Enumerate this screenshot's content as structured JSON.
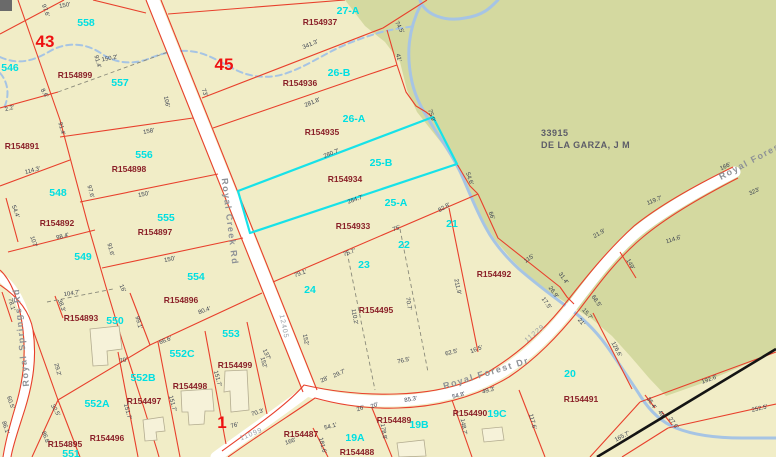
{
  "map": {
    "owner": {
      "line1": "33915",
      "line2": "DE LA GARZA, J M",
      "x": 541,
      "y": 133
    },
    "block_numbers": [
      {
        "t": "43",
        "x": 45,
        "y": 47
      },
      {
        "t": "45",
        "x": 224,
        "y": 70
      },
      {
        "t": "1",
        "x": 222,
        "y": 428
      }
    ],
    "lot_numbers": [
      {
        "t": "558",
        "x": 86,
        "y": 26
      },
      {
        "t": "546",
        "x": 10,
        "y": 71
      },
      {
        "t": "557",
        "x": 120,
        "y": 86
      },
      {
        "t": "27-A",
        "x": 348,
        "y": 14
      },
      {
        "t": "26-B",
        "x": 339,
        "y": 76
      },
      {
        "t": "26-A",
        "x": 354,
        "y": 122
      },
      {
        "t": "25-B",
        "x": 381,
        "y": 166
      },
      {
        "t": "25-A",
        "x": 396,
        "y": 206
      },
      {
        "t": "556",
        "x": 144,
        "y": 158
      },
      {
        "t": "548",
        "x": 58,
        "y": 196
      },
      {
        "t": "555",
        "x": 166,
        "y": 221
      },
      {
        "t": "549",
        "x": 83,
        "y": 260
      },
      {
        "t": "554",
        "x": 196,
        "y": 280
      },
      {
        "t": "550",
        "x": 115,
        "y": 324
      },
      {
        "t": "553",
        "x": 231,
        "y": 337
      },
      {
        "t": "552C",
        "x": 182,
        "y": 357
      },
      {
        "t": "552B",
        "x": 143,
        "y": 381
      },
      {
        "t": "552A",
        "x": 97,
        "y": 407
      },
      {
        "t": "551",
        "x": 71,
        "y": 457
      },
      {
        "t": "21",
        "x": 452,
        "y": 227
      },
      {
        "t": "22",
        "x": 404,
        "y": 248
      },
      {
        "t": "23",
        "x": 364,
        "y": 268
      },
      {
        "t": "24",
        "x": 310,
        "y": 293
      },
      {
        "t": "19A",
        "x": 355,
        "y": 441
      },
      {
        "t": "19B",
        "x": 419,
        "y": 428
      },
      {
        "t": "19C",
        "x": 497,
        "y": 417
      },
      {
        "t": "20",
        "x": 570,
        "y": 377
      }
    ],
    "parcel_ids": [
      {
        "t": "R154899",
        "x": 75,
        "y": 78
      },
      {
        "t": "R154937",
        "x": 320,
        "y": 25
      },
      {
        "t": "R154936",
        "x": 300,
        "y": 86
      },
      {
        "t": "R154935",
        "x": 322,
        "y": 135
      },
      {
        "t": "R154934",
        "x": 345,
        "y": 182
      },
      {
        "t": "R154933",
        "x": 353,
        "y": 229
      },
      {
        "t": "R154891",
        "x": 22,
        "y": 149
      },
      {
        "t": "R154898",
        "x": 129,
        "y": 172
      },
      {
        "t": "R154892",
        "x": 57,
        "y": 226
      },
      {
        "t": "R154897",
        "x": 155,
        "y": 235
      },
      {
        "t": "R154896",
        "x": 181,
        "y": 303
      },
      {
        "t": "R154893",
        "x": 81,
        "y": 321
      },
      {
        "t": "R154499",
        "x": 235,
        "y": 368
      },
      {
        "t": "R154498",
        "x": 190,
        "y": 389
      },
      {
        "t": "R154497",
        "x": 144,
        "y": 404
      },
      {
        "t": "R154496",
        "x": 107,
        "y": 441
      },
      {
        "t": "R154895",
        "x": 65,
        "y": 447
      },
      {
        "t": "R154495",
        "x": 376,
        "y": 313
      },
      {
        "t": "R154492",
        "x": 494,
        "y": 277
      },
      {
        "t": "R154487",
        "x": 301,
        "y": 437
      },
      {
        "t": "R154488",
        "x": 357,
        "y": 455
      },
      {
        "t": "R154489",
        "x": 394,
        "y": 423
      },
      {
        "t": "R154490",
        "x": 470,
        "y": 416
      },
      {
        "t": "R154491",
        "x": 581,
        "y": 402
      }
    ],
    "road_labels": [
      {
        "t": "Royal Creek Rd",
        "x": 227,
        "y": 222,
        "r": 83,
        "cls": "road"
      },
      {
        "t": "Royal Springs Rd",
        "x": 24,
        "y": 337,
        "r": -96,
        "cls": "road"
      },
      {
        "t": "Royal Forest Dr",
        "x": 487,
        "y": 376,
        "r": -17,
        "cls": "road"
      },
      {
        "t": "Royal Forest",
        "x": 753,
        "y": 163,
        "r": -28,
        "cls": "road"
      },
      {
        "t": "11099",
        "x": 252,
        "y": 436,
        "r": -22,
        "cls": "roadnum"
      },
      {
        "t": "11229",
        "x": 536,
        "y": 335,
        "r": -40,
        "cls": "roadnum"
      },
      {
        "t": "12405",
        "x": 282,
        "y": 327,
        "r": 78,
        "cls": "roadnum"
      }
    ],
    "measurements": [
      {
        "t": "150'",
        "x": 65,
        "y": 7,
        "r": -10
      },
      {
        "t": "150.2'",
        "x": 110,
        "y": 60,
        "r": -11
      },
      {
        "t": "2.2'",
        "x": 10,
        "y": 110,
        "r": -15
      },
      {
        "t": "8.6'",
        "x": 43,
        "y": 94,
        "r": 60
      },
      {
        "t": "91.4'",
        "x": 96,
        "y": 62,
        "r": 75
      },
      {
        "t": "91.4'",
        "x": 60,
        "y": 129,
        "r": 75
      },
      {
        "t": "97.6'",
        "x": 44,
        "y": 11,
        "r": 70
      },
      {
        "t": "158'",
        "x": 149,
        "y": 133,
        "r": -11
      },
      {
        "t": "106'",
        "x": 165,
        "y": 102,
        "r": 78
      },
      {
        "t": "73'",
        "x": 203,
        "y": 93,
        "r": 70
      },
      {
        "t": "114.3'",
        "x": 33,
        "y": 172,
        "r": -15
      },
      {
        "t": "54.4'",
        "x": 14,
        "y": 212,
        "r": 70
      },
      {
        "t": "97.6'",
        "x": 89,
        "y": 192,
        "r": 75
      },
      {
        "t": "150'",
        "x": 144,
        "y": 196,
        "r": -12
      },
      {
        "t": "107'",
        "x": 32,
        "y": 242,
        "r": 72
      },
      {
        "t": "98.4'",
        "x": 63,
        "y": 238,
        "r": -14
      },
      {
        "t": "91.6'",
        "x": 109,
        "y": 250,
        "r": 75
      },
      {
        "t": "150'",
        "x": 170,
        "y": 261,
        "r": -12
      },
      {
        "t": "16'",
        "x": 121,
        "y": 289,
        "r": 65
      },
      {
        "t": "104.7'",
        "x": 72,
        "y": 295,
        "r": -9
      },
      {
        "t": "38.3'",
        "x": 60,
        "y": 306,
        "r": 70
      },
      {
        "t": "78.1'",
        "x": 10,
        "y": 305,
        "r": 75
      },
      {
        "t": "60.5'",
        "x": 9,
        "y": 403,
        "r": 72
      },
      {
        "t": "86.1'",
        "x": 4,
        "y": 428,
        "r": 72
      },
      {
        "t": "86.8'",
        "x": 44,
        "y": 438,
        "r": 70
      },
      {
        "t": "29.2'",
        "x": 56,
        "y": 370,
        "r": 75
      },
      {
        "t": "32.5'",
        "x": 54,
        "y": 411,
        "r": 60
      },
      {
        "t": "99.1'",
        "x": 137,
        "y": 323,
        "r": 75
      },
      {
        "t": "66.6'",
        "x": 166,
        "y": 342,
        "r": -20
      },
      {
        "t": "70'",
        "x": 124,
        "y": 362,
        "r": -15
      },
      {
        "t": "80.4'",
        "x": 205,
        "y": 312,
        "r": -20
      },
      {
        "t": "151.7'",
        "x": 126,
        "y": 412,
        "r": 75
      },
      {
        "t": "151.7'",
        "x": 171,
        "y": 404,
        "r": 75
      },
      {
        "t": "151.7'",
        "x": 216,
        "y": 379,
        "r": 75
      },
      {
        "t": "152'",
        "x": 262,
        "y": 363,
        "r": 75
      },
      {
        "t": "70.3'",
        "x": 258,
        "y": 414,
        "r": -18
      },
      {
        "t": "76'",
        "x": 235,
        "y": 427,
        "r": -15
      },
      {
        "t": "166'",
        "x": 291,
        "y": 443,
        "r": -18
      },
      {
        "t": "54.1'",
        "x": 331,
        "y": 428,
        "r": -15
      },
      {
        "t": "181.6'",
        "x": 321,
        "y": 446,
        "r": 75
      },
      {
        "t": "178.8'",
        "x": 382,
        "y": 432,
        "r": 80
      },
      {
        "t": "148.7'",
        "x": 462,
        "y": 427,
        "r": 80
      },
      {
        "t": "117.6'",
        "x": 531,
        "y": 422,
        "r": 75
      },
      {
        "t": "126.6'",
        "x": 615,
        "y": 350,
        "r": 62
      },
      {
        "t": "192.6'",
        "x": 710,
        "y": 381,
        "r": -20
      },
      {
        "t": "252.5'",
        "x": 760,
        "y": 410,
        "r": -13
      },
      {
        "t": "165.7'",
        "x": 623,
        "y": 438,
        "r": -28
      },
      {
        "t": "35.4'",
        "x": 650,
        "y": 404,
        "r": 55
      },
      {
        "t": "49'",
        "x": 660,
        "y": 415,
        "r": 55
      },
      {
        "t": "27.6'",
        "x": 672,
        "y": 424,
        "r": 55
      },
      {
        "t": "21'",
        "x": 580,
        "y": 323,
        "r": 50
      },
      {
        "t": "15.7'",
        "x": 586,
        "y": 315,
        "r": 50
      },
      {
        "t": "68.5'",
        "x": 595,
        "y": 302,
        "r": 55
      },
      {
        "t": "17.5'",
        "x": 545,
        "y": 304,
        "r": 55
      },
      {
        "t": "26.9'",
        "x": 552,
        "y": 293,
        "r": 55
      },
      {
        "t": "31.4'",
        "x": 562,
        "y": 279,
        "r": 55
      },
      {
        "t": "115'",
        "x": 530,
        "y": 260,
        "r": -35
      },
      {
        "t": "66'",
        "x": 490,
        "y": 216,
        "r": 70
      },
      {
        "t": "21.9'",
        "x": 600,
        "y": 235,
        "r": -30
      },
      {
        "t": "211.9'",
        "x": 456,
        "y": 287,
        "r": 78
      },
      {
        "t": "82.8'",
        "x": 445,
        "y": 209,
        "r": -30
      },
      {
        "t": "54.6'",
        "x": 468,
        "y": 179,
        "r": 72
      },
      {
        "t": "75.9'",
        "x": 430,
        "y": 116,
        "r": 72
      },
      {
        "t": "41'",
        "x": 397,
        "y": 58,
        "r": 75
      },
      {
        "t": "74.5'",
        "x": 398,
        "y": 28,
        "r": 62
      },
      {
        "t": "341.3'",
        "x": 311,
        "y": 46,
        "r": -23
      },
      {
        "t": "281.8'",
        "x": 313,
        "y": 104,
        "r": -23
      },
      {
        "t": "280.7'",
        "x": 332,
        "y": 155,
        "r": -22
      },
      {
        "t": "284.7'",
        "x": 356,
        "y": 201,
        "r": -20
      },
      {
        "t": "75'",
        "x": 397,
        "y": 230,
        "r": -20
      },
      {
        "t": "75.7'",
        "x": 350,
        "y": 254,
        "r": -20
      },
      {
        "t": "79.1'",
        "x": 301,
        "y": 275,
        "r": -20
      },
      {
        "t": "70.7'",
        "x": 407,
        "y": 304,
        "r": 80
      },
      {
        "t": "110.2'",
        "x": 353,
        "y": 317,
        "r": 80
      },
      {
        "t": "152'",
        "x": 304,
        "y": 340,
        "r": 78
      },
      {
        "t": "137'",
        "x": 265,
        "y": 355,
        "r": 65
      },
      {
        "t": "28'",
        "x": 325,
        "y": 381,
        "r": -25
      },
      {
        "t": "29.7'",
        "x": 340,
        "y": 375,
        "r": -25
      },
      {
        "t": "76.5'",
        "x": 404,
        "y": 362,
        "r": -13
      },
      {
        "t": "62.5'",
        "x": 452,
        "y": 354,
        "r": -15
      },
      {
        "t": "16.5'",
        "x": 477,
        "y": 351,
        "r": -20
      },
      {
        "t": "85.3'",
        "x": 411,
        "y": 401,
        "r": -10
      },
      {
        "t": "26'",
        "x": 361,
        "y": 410,
        "r": -20
      },
      {
        "t": "20'",
        "x": 375,
        "y": 407,
        "r": -20
      },
      {
        "t": "54.8'",
        "x": 459,
        "y": 397,
        "r": -15
      },
      {
        "t": "49.3'",
        "x": 489,
        "y": 392,
        "r": -15
      },
      {
        "t": "166'",
        "x": 726,
        "y": 168,
        "r": -25
      },
      {
        "t": "119.7'",
        "x": 655,
        "y": 202,
        "r": -22
      },
      {
        "t": "323'",
        "x": 755,
        "y": 193,
        "r": -25
      },
      {
        "t": "114.6'",
        "x": 674,
        "y": 241,
        "r": -18
      },
      {
        "t": "149'",
        "x": 629,
        "y": 265,
        "r": 60
      }
    ],
    "colors": {
      "parcel_fill": "#f1edc7",
      "undeveloped_fill": "#d4d9a0",
      "parcel_line": "#e8402c",
      "highlight": "#17e2e8",
      "water": "#a6c4e4",
      "lot_label": "#00dfe2",
      "parcel_id_label": "#8a2028",
      "block_label": "#ee1212",
      "road_label": "#8d9196"
    }
  }
}
